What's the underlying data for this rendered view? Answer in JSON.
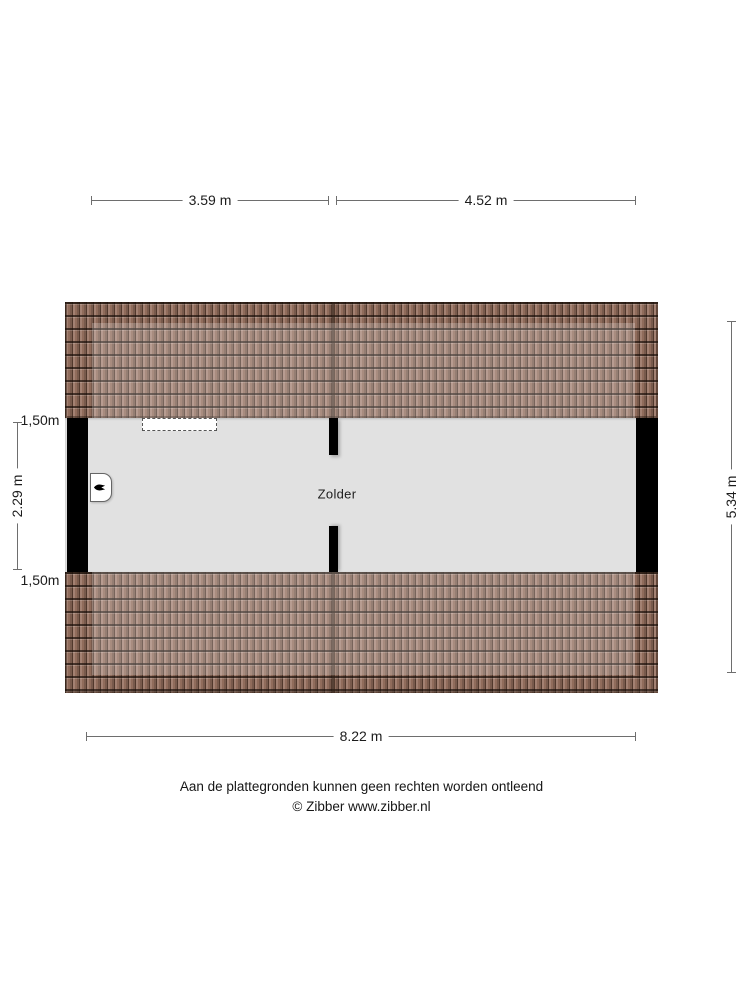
{
  "plan": {
    "room_label": "Zolder",
    "dimensions": {
      "top_left": "3.59 m",
      "top_right": "4.52 m",
      "bottom": "8.22 m",
      "left_upper": "1,50m",
      "left_middle": "2.29 m",
      "left_lower": "1,50m",
      "right": "5.34 m"
    },
    "features": {
      "skylight": "dashed roof window",
      "entrance_icon": "arrow glyph on door panel"
    },
    "colors": {
      "roof_tile": "#96705f",
      "roof_ridge": "#40322a",
      "floor": "#e1e1e1",
      "wall": "#000000",
      "dim_line": "#6e6e6e",
      "text": "#1a1a1a",
      "background": "#ffffff"
    }
  },
  "footer": {
    "disclaimer": "Aan de plattegronden kunnen geen rechten worden ontleend",
    "credit": "© Zibber www.zibber.nl"
  }
}
